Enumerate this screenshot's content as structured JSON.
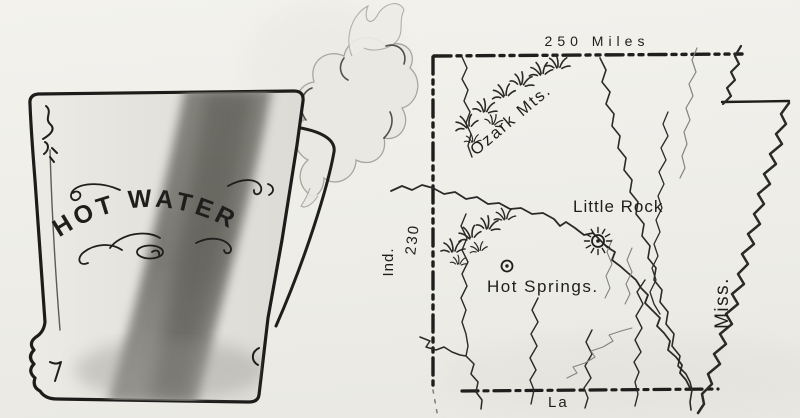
{
  "illustration": {
    "title": "Hot-water pitcher and sketch map of Arkansas",
    "pitcher": {
      "label": "HOT WATER"
    },
    "map": {
      "scale_north": "250 Miles",
      "scale_west": "230",
      "neighbor_west": "Ind.",
      "neighbor_east": "Miss.",
      "neighbor_south": "La",
      "mountains": "Ozark Mts.",
      "cities": [
        {
          "name": "Little Rock",
          "symbol": "sun-icon"
        },
        {
          "name": "Hot Springs.",
          "symbol": "circled-dot-icon"
        }
      ]
    }
  },
  "colors": {
    "ink": "#1f1e1c",
    "paper": "#f1f0eb",
    "pitcher_wash_light": "#e6e5df",
    "pitcher_wash_dark": "#6f6e68",
    "steam": "#e9e8e2"
  }
}
